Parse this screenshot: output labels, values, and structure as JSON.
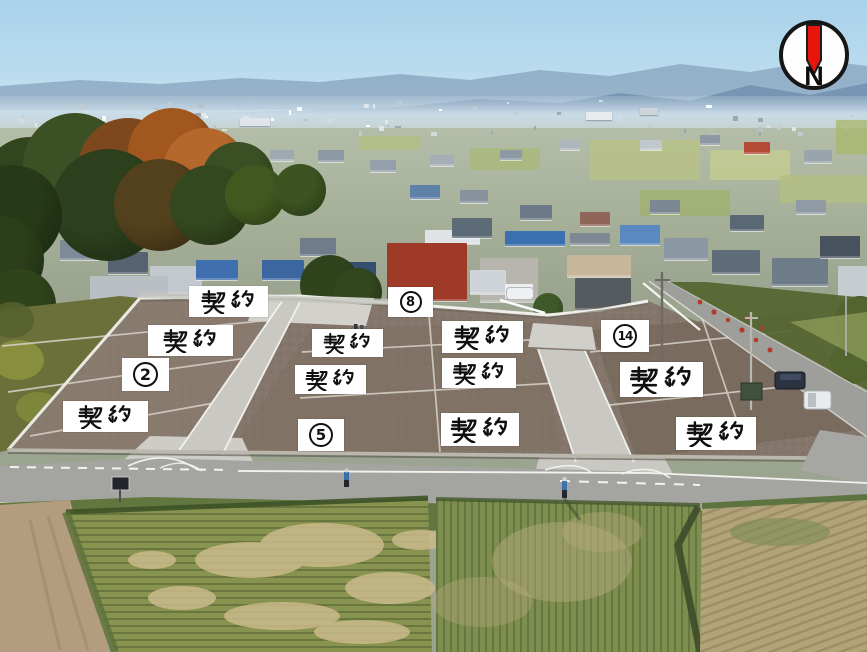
{
  "compass": {
    "letter": "N",
    "needle_color": "#e8150d",
    "circle_color": "#fdfdfd",
    "border_color": "#161616"
  },
  "overlays": {
    "sold_text": "契約",
    "sold_labels": [
      {
        "x": 189,
        "y": 286,
        "w": 79,
        "h": 31
      },
      {
        "x": 148,
        "y": 325,
        "w": 85,
        "h": 31
      },
      {
        "x": 63,
        "y": 401,
        "w": 85,
        "h": 31
      },
      {
        "x": 312,
        "y": 329,
        "w": 71,
        "h": 28
      },
      {
        "x": 295,
        "y": 365,
        "w": 71,
        "h": 29
      },
      {
        "x": 442,
        "y": 321,
        "w": 81,
        "h": 32
      },
      {
        "x": 442,
        "y": 358,
        "w": 74,
        "h": 30
      },
      {
        "x": 441,
        "y": 413,
        "w": 78,
        "h": 33
      },
      {
        "x": 620,
        "y": 362,
        "w": 83,
        "h": 35
      },
      {
        "x": 676,
        "y": 417,
        "w": 80,
        "h": 33
      }
    ],
    "lot_numbers": [
      {
        "value": "2",
        "x": 122,
        "y": 358,
        "w": 47,
        "h": 33
      },
      {
        "value": "5",
        "x": 298,
        "y": 419,
        "w": 46,
        "h": 32
      },
      {
        "value": "8",
        "x": 388,
        "y": 287,
        "w": 45,
        "h": 30
      },
      {
        "value": "14",
        "x": 601,
        "y": 320,
        "w": 48,
        "h": 32
      }
    ]
  },
  "palette": {
    "sky_top": "#a9d2ea",
    "sky_horizon": "#dcebf3",
    "mountain_far": "#8ba6c1",
    "mountain_near": "#6d8cab",
    "haze": "#c9dbe7",
    "site_dirt": "#84766a",
    "site_dirt_dark": "#6d5f52",
    "concrete": "#c9c8c3",
    "concrete_bright": "#d6d5cf",
    "asphalt": "#a4a4a1",
    "road_line": "#f2f2ee",
    "grass": "#62763f",
    "field_green": "#87934f",
    "field_tan": "#cbba8b",
    "dirt_path": "#b49d7e",
    "label_bg": "#ffffff",
    "label_fg": "#111111",
    "compass_bg": "#fdfdfd",
    "compass_border": "#161616"
  }
}
